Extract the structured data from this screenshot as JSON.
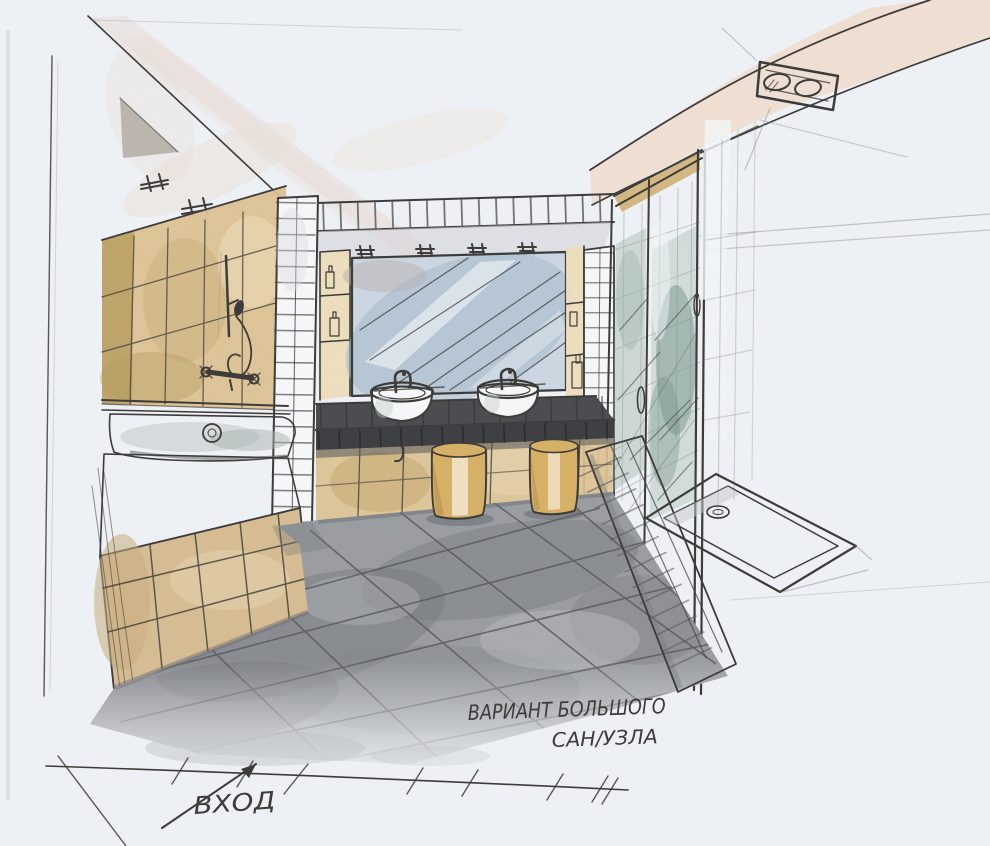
{
  "title": {
    "line1": "ВАРИАНТ БОЛЬШОГО",
    "line2": "САН/УЗЛА"
  },
  "entrance": {
    "label": "ВХОД"
  },
  "palette": {
    "paper": "#eef1f5",
    "ink": "#3d3c3a",
    "pencil": "#8e9094",
    "tile_tan": "#dcc292",
    "tile_tan_dark": "#b79c60",
    "tile_tan_light": "#ecdcba",
    "apron_tan": "#d7bd93",
    "stool": "#d6b166",
    "stool_dark": "#b08c4a",
    "stool_light": "#f3e9d2",
    "ceiling_peach": "#f0dccb",
    "ceiling_pink": "#e9d9d5",
    "wedge_brown": "#968b7e",
    "mirror_blue": "#c6d2de",
    "mirror_deep": "#a9bccd",
    "glass_teal": "#92ab9f",
    "glass_deep": "#6f8f84",
    "counter": "#4b4d51",
    "counter_face": "#3e4043",
    "floor": "#9a9da1",
    "floor_dark": "#76787d",
    "floor_light": "#b6b9be",
    "shadow": "#6e7075",
    "white_fixture": "#f5f7f8"
  }
}
